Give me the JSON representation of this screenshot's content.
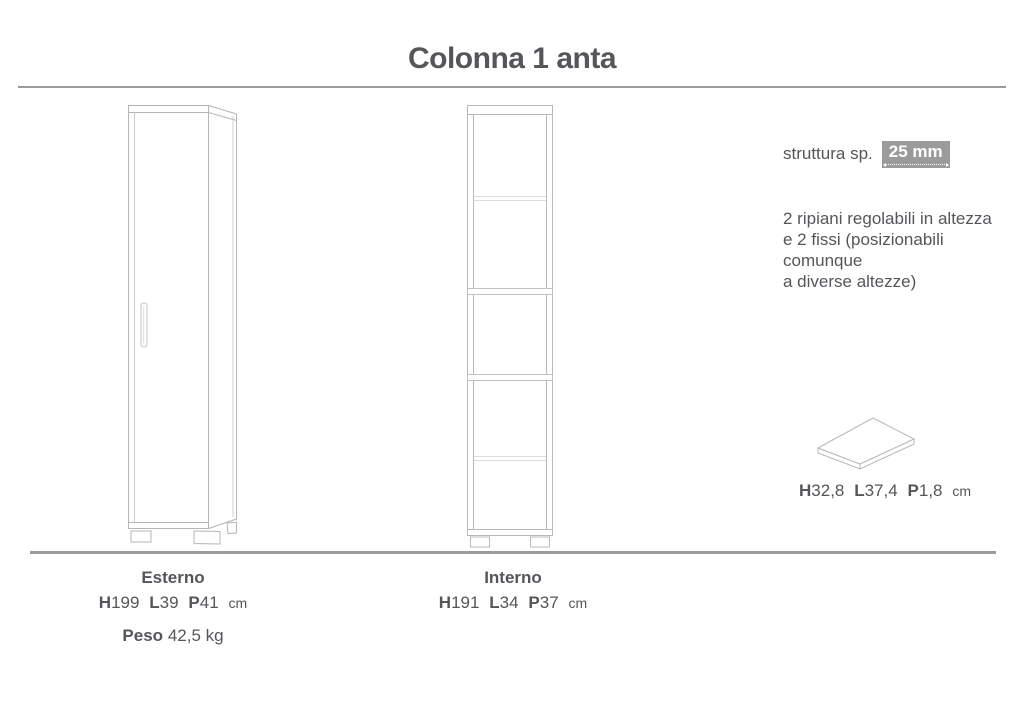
{
  "page": {
    "title": "Colonna 1 anta"
  },
  "spec_panel": {
    "structure_label": "struttura sp.",
    "structure_value": "25 mm",
    "shelves_note": [
      "2 ripiani regolabili in altezza",
      "e 2 fissi (posizionabili comunque",
      "a diverse altezze)"
    ],
    "shelf_dims": {
      "h_label": "H",
      "h_value": "32,8",
      "l_label": "L",
      "l_value": "37,4",
      "p_label": "P",
      "p_value": "1,8",
      "unit": "cm"
    }
  },
  "exterior": {
    "label": "Esterno",
    "h_label": "H",
    "h_value": "199",
    "l_label": "L",
    "l_value": "39",
    "p_label": "P",
    "p_value": "41",
    "unit": "cm",
    "weight_label": "Peso",
    "weight_value": "42,5 kg"
  },
  "interior": {
    "label": "Interno",
    "h_label": "H",
    "h_value": "191",
    "l_label": "L",
    "l_value": "34",
    "p_label": "P",
    "p_value": "37",
    "unit": "cm"
  },
  "colors": {
    "text": "#55565a",
    "line_art": "#b5b5b5",
    "light_line": "#d9d9d9",
    "rule": "#9b9b9b",
    "value_box_bg": "#9b9b9b",
    "value_box_text": "#ffffff"
  }
}
